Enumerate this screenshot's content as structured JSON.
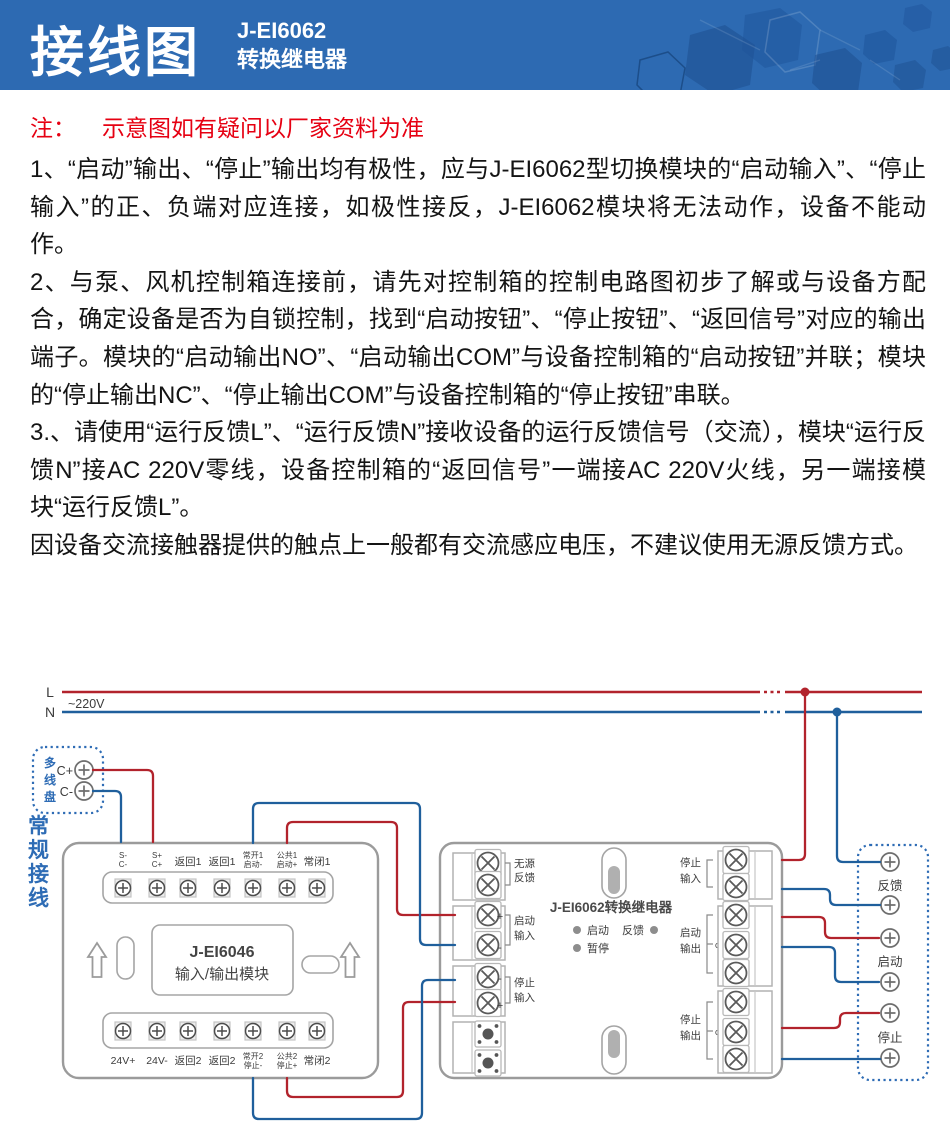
{
  "header": {
    "title": "接线图",
    "model": "J-EI6062",
    "type": "转换继电器"
  },
  "note": {
    "prefix": "注：",
    "text": "示意图如有疑问以厂家资料为准"
  },
  "paragraphs": [
    "1、“启动”输出、“停止”输出均有极性，应与J-EI6062型切换模块的“启动输入”、“停止输入”的正、负端对应连接，如极性接反，J-EI6062模块将无法动作，设备不能动作。",
    "2、与泵、风机控制箱连接前，请先对控制箱的控制电路图初步了解或与设备方配合，确定设备是否为自锁控制，找到“启动按钮”、“停止按钮”、“返回信号”对应的输出端子。模块的“启动输出NO”、“启动输出COM”与设备控制箱的“启动按钮”并联；模块的“停止输出NC”、“停止输出COM”与设备控制箱的“停止按钮”串联。",
    "3.、请使用“运行反馈L”、“运行反馈N”接收设备的运行反馈信号（交流），模块“运行反馈N”接AC 220V零线，设备控制箱的“返回信号”一端接AC 220V火线，另一端接模块“运行反馈L”。",
    "因设备交流接触器提供的触点上一般都有交流感应电压，不建议使用无源反馈方式。"
  ],
  "diagram": {
    "power": {
      "l_label": "L",
      "n_label": "N",
      "voltage": "~220V"
    },
    "panel": {
      "name": "多线盘",
      "chars": [
        "多",
        "线",
        "盘"
      ],
      "c_plus": "C+",
      "c_minus": "C-"
    },
    "wiring_label": {
      "text": "常规接线",
      "chars": [
        "常",
        "规",
        "接",
        "线"
      ]
    },
    "m46": {
      "title": "J-EI6046",
      "subtitle": "输入/输出模块",
      "top": [
        {
          "l1": "S-",
          "l2": "C-"
        },
        {
          "l1": "S+",
          "l2": "C+"
        },
        {
          "l1": "返回1",
          "l2": ""
        },
        {
          "l1": "返回1",
          "l2": ""
        },
        {
          "l1": "常开1",
          "l2": "启动-"
        },
        {
          "l1": "公共1",
          "l2": "启动+"
        },
        {
          "l1": "常闭1",
          "l2": ""
        }
      ],
      "bottom": [
        {
          "l1": "24V+",
          "l2": ""
        },
        {
          "l1": "24V-",
          "l2": ""
        },
        {
          "l1": "返回2",
          "l2": ""
        },
        {
          "l1": "返回2",
          "l2": ""
        },
        {
          "l1": "常开2",
          "l2": "停止-"
        },
        {
          "l1": "公共2",
          "l2": "停止+"
        },
        {
          "l1": "常闭2",
          "l2": ""
        }
      ]
    },
    "m62": {
      "title": "J-EI6062转换继电器",
      "led_start": "启动",
      "led_feedback": "反馈",
      "led_pause": "暂停",
      "in_passive": {
        "l1": "无源",
        "l2": "反馈"
      },
      "in_start": {
        "plus": "+",
        "minus": "-",
        "l1": "启动",
        "l2": "输入"
      },
      "in_stop": {
        "plus": "+",
        "minus": "-",
        "l1": "停止",
        "l2": "输入"
      },
      "out_ln": {
        "l1": "停止",
        "l2": "输入",
        "t1": "L",
        "t2": "N"
      },
      "out_start": {
        "l1": "启动",
        "l2": "输出",
        "t1": "NO",
        "t2": "COM",
        "t3": "NC"
      },
      "out_stop": {
        "l1": "停止",
        "l2": "输出",
        "t1": "NO",
        "t2": "COM",
        "t3": "NC"
      }
    },
    "device": {
      "labels": [
        "反馈",
        "启动",
        "停止"
      ]
    }
  },
  "colors": {
    "banner": "#2d6ab2",
    "note_red": "#e60012",
    "wire_red": "#b2232c",
    "wire_blue": "#1f5f9c",
    "diagram_blue": "#2e6cb5"
  }
}
